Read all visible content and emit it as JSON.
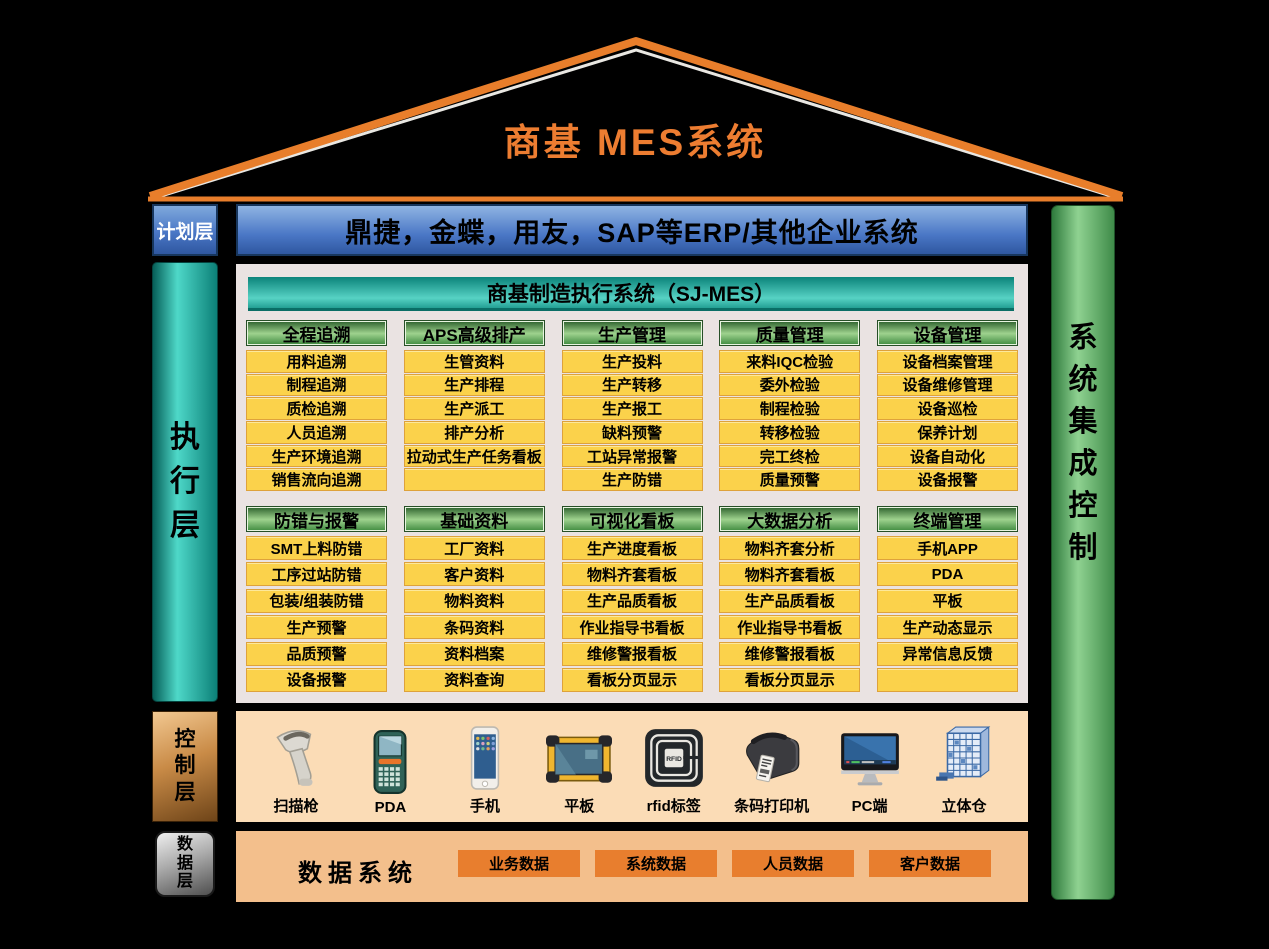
{
  "roof": {
    "title": "商基  MES系统"
  },
  "planning": {
    "label": "计划层",
    "erp_bar": "鼎捷，金蝶，用友，SAP等ERP/其他企业系统"
  },
  "execution": {
    "label": "执行层",
    "panel_title": "商基制造执行系统（SJ-MES）",
    "groups_row1": [
      {
        "header": "全程追溯",
        "items": [
          "用料追溯",
          "制程追溯",
          "质检追溯",
          "人员追溯",
          "生产环境追溯",
          "销售流向追溯"
        ]
      },
      {
        "header": "APS高级排产",
        "items": [
          "生管资料",
          "生产排程",
          "生产派工",
          "排产分析",
          "拉动式生产任务看板",
          ""
        ]
      },
      {
        "header": "生产管理",
        "items": [
          "生产投料",
          "生产转移",
          "生产报工",
          "缺料预警",
          "工站异常报警",
          "生产防错"
        ]
      },
      {
        "header": "质量管理",
        "items": [
          "来料IQC检验",
          "委外检验",
          "制程检验",
          "转移检验",
          "完工终检",
          "质量预警"
        ]
      },
      {
        "header": "设备管理",
        "items": [
          "设备档案管理",
          "设备维修管理",
          "设备巡检",
          "保养计划",
          "设备自动化",
          "设备报警"
        ]
      }
    ],
    "groups_row2": [
      {
        "header": "防错与报警",
        "items": [
          "SMT上料防错",
          "工序过站防错",
          "包装/组装防错",
          "生产预警",
          "品质预警",
          "设备报警"
        ]
      },
      {
        "header": "基础资料",
        "items": [
          "工厂资料",
          "客户资料",
          "物料资料",
          "条码资料",
          "资料档案",
          "资料查询"
        ]
      },
      {
        "header": "可视化看板",
        "items": [
          "生产进度看板",
          "物料齐套看板",
          "生产品质看板",
          "作业指导书看板",
          "维修警报看板",
          "看板分页显示"
        ]
      },
      {
        "header": "大数据分析",
        "items": [
          "物料齐套分析",
          "物料齐套看板",
          "生产品质看板",
          "作业指导书看板",
          "维修警报看板",
          "看板分页显示"
        ]
      },
      {
        "header": "终端管理",
        "items": [
          "手机APP",
          "PDA",
          "平板",
          "生产动态显示",
          "异常信息反馈",
          ""
        ]
      }
    ]
  },
  "control": {
    "label": "控制层",
    "devices": [
      {
        "label": "扫描枪",
        "icon": "scanner-gun-icon"
      },
      {
        "label": "PDA",
        "icon": "pda-icon"
      },
      {
        "label": "手机",
        "icon": "phone-icon"
      },
      {
        "label": "平板",
        "icon": "tablet-icon"
      },
      {
        "label": "rfid标签",
        "icon": "rfid-tag-icon"
      },
      {
        "label": "条码打印机",
        "icon": "label-printer-icon"
      },
      {
        "label": "PC端",
        "icon": "desktop-icon"
      },
      {
        "label": "立体仓",
        "icon": "warehouse-icon"
      }
    ]
  },
  "data_layer": {
    "label": "数据层",
    "title": "数据系统",
    "items": [
      "业务数据",
      "系统数据",
      "人员数据",
      "客户数据"
    ]
  },
  "right_bar": {
    "label": "系统集成控制"
  },
  "colors": {
    "roof_orange": "#E87E2B",
    "title_orange": "#ED7D31",
    "erp_blue": "#4A77C6",
    "teal": "#2BB5A8",
    "module_yellow": "#FBD24B",
    "module_border": "#DEA23B",
    "header_green": "#7CC06E",
    "control_band_peach": "#FBDCB6",
    "data_band_peach": "#F3BF8C",
    "data_box_orange": "#E87E2E",
    "right_bar_green": "#6FBE74"
  }
}
